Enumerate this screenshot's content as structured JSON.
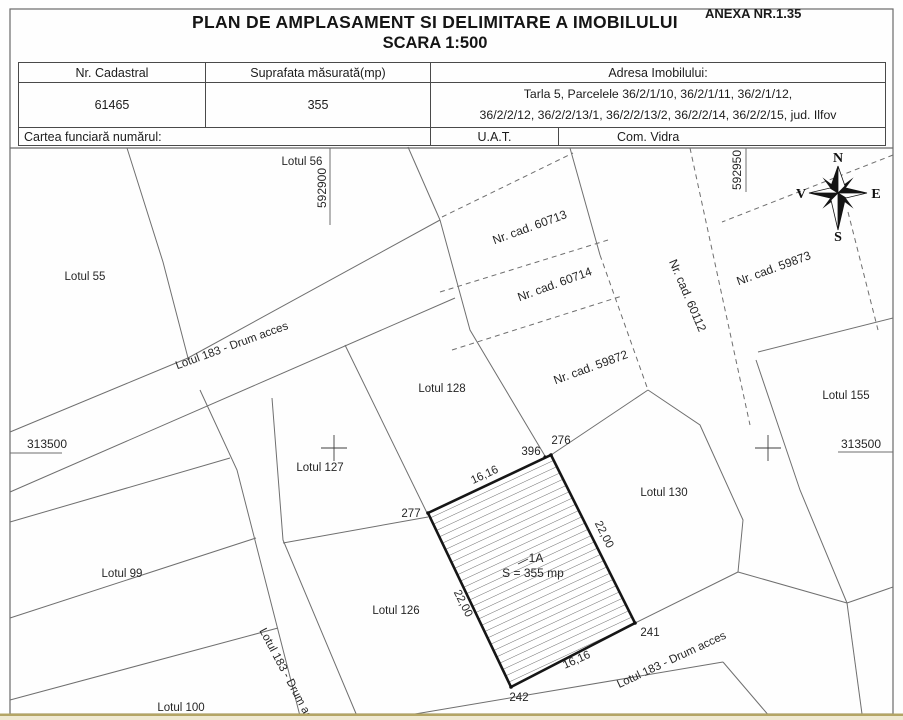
{
  "header": {
    "title": "PLAN DE AMPLASAMENT SI DELIMITARE A IMOBILULUI",
    "subtitle": "SCARA 1:500",
    "annex": "ANEXA NR.1.35"
  },
  "info_table": {
    "col_cadastral_header": "Nr. Cadastral",
    "col_area_header": "Suprafata măsurată(mp)",
    "col_address_header": "Adresa Imobilului:",
    "cadastral_number": "61465",
    "measured_area_mp": "355",
    "address_line1": "Tarla 5, Parcelele 36/2/1/10, 36/2/1/11, 36/2/1/12,",
    "address_line2": "36/2/2/12, 36/2/2/13/1, 36/2/2/13/2, 36/2/2/14, 36/2/2/15, jud. Ilfov",
    "land_book_label": "Cartea funciară numărul:",
    "uat_label": "U.A.T.",
    "uat_value": "Com. Vidra"
  },
  "compass": {
    "n": "N",
    "e": "E",
    "s": "S",
    "v": "V"
  },
  "grid": {
    "easting_left": "592900",
    "easting_right": "592950",
    "northing_left": "313500",
    "northing_right": "313500"
  },
  "lots": {
    "lot56": "Lotul 56",
    "lot55": "Lotul 55",
    "lot99": "Lotul 99",
    "lot100": "Lotul 100",
    "lot126": "Lotul 126",
    "lot127": "Lotul 127",
    "lot128": "Lotul 128",
    "lot130": "Lotul 130",
    "lot155": "Lotul 155",
    "road_upper": "Lotul 183 - Drum acces",
    "road_lower": "Lotul 183 - Drum acces",
    "road_vertical": "Lotul 183 - Drum acces"
  },
  "cadastral_numbers": {
    "c60713": "Nr. cad. 60713",
    "c60714": "Nr. cad. 60714",
    "c60112": "Nr. cad. 60112",
    "c59873": "Nr. cad. 59873",
    "c59872": "Nr. cad. 59872"
  },
  "parcel": {
    "id": "1A",
    "area": "S = 355 mp",
    "point_276": "276",
    "point_277": "277",
    "point_241": "241",
    "point_242": "242",
    "point_396": "396",
    "side_top": "16,16",
    "side_right": "22,00",
    "side_bottom": "16,16",
    "side_left": "22,00"
  }
}
